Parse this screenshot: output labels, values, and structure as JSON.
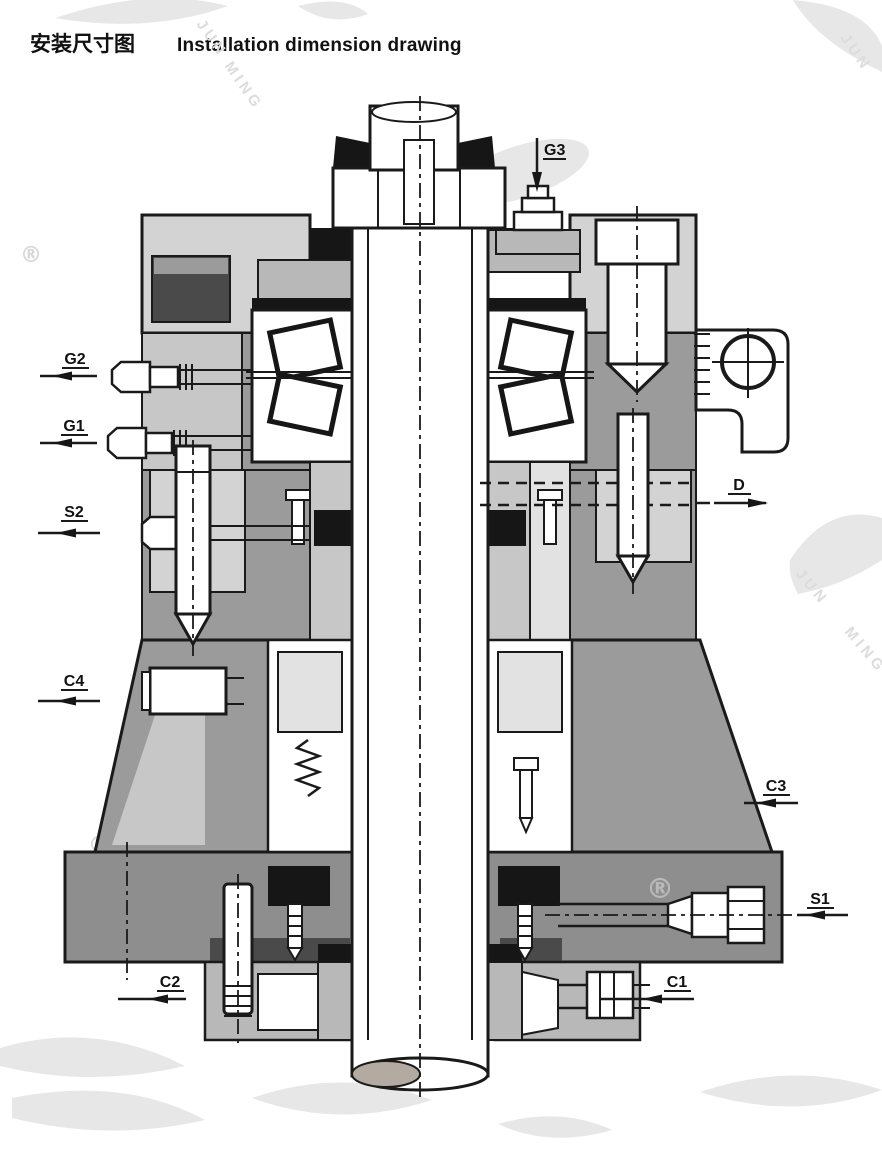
{
  "header": {
    "title_zh": "安装尺寸图",
    "title_en": "Installation dimension drawing"
  },
  "drawing": {
    "name": "vertical-shaft-seal-bearing-assembly-cross-section",
    "ports": [
      {
        "id": "G3",
        "side": "top",
        "arrow": "down"
      },
      {
        "id": "G2",
        "side": "left",
        "arrow": "left"
      },
      {
        "id": "G1",
        "side": "left",
        "arrow": "left"
      },
      {
        "id": "S2",
        "side": "left",
        "arrow": "left"
      },
      {
        "id": "C4",
        "side": "left",
        "arrow": "left"
      },
      {
        "id": "D",
        "side": "right",
        "arrow": "right"
      },
      {
        "id": "C3",
        "side": "right",
        "arrow": "left"
      },
      {
        "id": "S1",
        "side": "right",
        "arrow": "left"
      },
      {
        "id": "C2",
        "side": "bottom-left",
        "arrow": "left"
      },
      {
        "id": "C1",
        "side": "bottom-right",
        "arrow": "left"
      }
    ]
  },
  "labels": {
    "g3": "G3",
    "g2": "G2",
    "g1": "G1",
    "s2": "S2",
    "c4": "C4",
    "d": "D",
    "c3": "C3",
    "s1": "S1",
    "c2": "C2",
    "c1": "C1"
  },
  "watermark": {
    "jun": "JUN",
    "ming": "MING",
    "registered": "®"
  },
  "colors": {
    "line": "#1a1a1a",
    "housing_light": "#d3d3d3",
    "housing_mid": "#9b9b9b",
    "flange": "#8e8e8e",
    "block_light": "#b8b8b8",
    "seal_black": "#161616",
    "watermark": "#e7e7e7",
    "background": "#ffffff"
  }
}
